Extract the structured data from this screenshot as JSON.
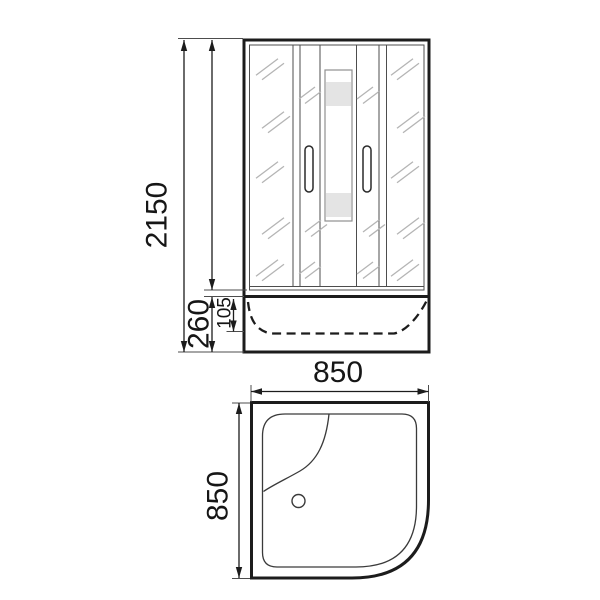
{
  "drawing": {
    "subject": "corner-shower-cabin-dimension-drawing",
    "views": {
      "front": "front-elevation",
      "top": "tray-plan"
    }
  },
  "front_view": {
    "dim_total_height": "2150",
    "dim_tray_height": "260",
    "dim_tray_inner_depth": "105"
  },
  "top_view": {
    "dim_width": "850",
    "dim_depth": "850"
  },
  "colors": {
    "background": "#ffffff",
    "line": "#1c1c1c",
    "thin_line": "#4d4d4d",
    "hatch": "#b4b4b4",
    "panel_outline": "#8f8f8f",
    "panel_band": "#e4e4e4"
  }
}
